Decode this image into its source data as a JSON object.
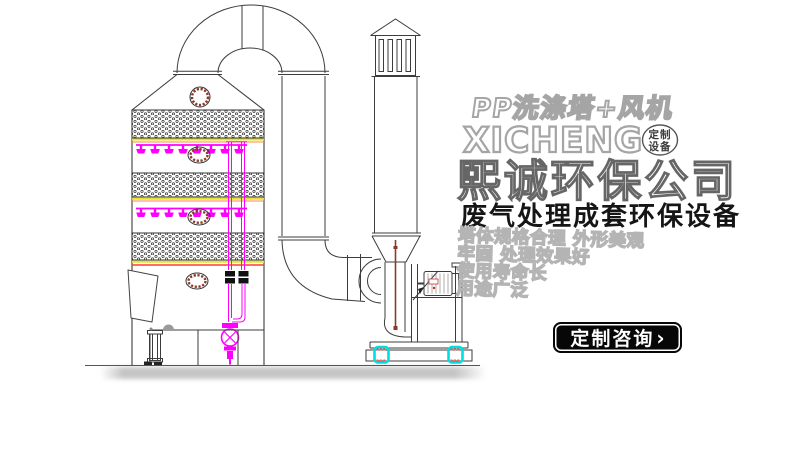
{
  "brand": {
    "product_line": "PP洗涤塔+风机",
    "brand_name": "XICHENG",
    "badge": {
      "line1": "定制",
      "line2": "设备"
    },
    "company_name": "熙诚环保公司",
    "tagline": "废气处理成套环保设备",
    "features": [
      "塔体规格合理 外形美观",
      "牢固 处理效果好",
      "使用寿命长",
      "用途广泛"
    ]
  },
  "cta": {
    "label": "定制咨询",
    "chevron": "›"
  },
  "drawing": {
    "type": "technical-cad-elevation",
    "components": [
      "packed-bed-scrubber-tower",
      "top-cone-with-sight-glass",
      "packing-layers-x3",
      "spray-nozzle-headers-x2",
      "manhole-ports",
      "feed-riser-pipes-with-valves",
      "circulation-pump",
      "water-tank",
      "access-door",
      "exhaust-elbow-duct",
      "centrifugal-fan",
      "fan-motor",
      "vibration-isolators",
      "exhaust-stack-with-rain-cap"
    ],
    "colors": {
      "linework": "#3c3c3c",
      "pipe_magenta": "#ff00ff",
      "support_yellow": "#e3e332",
      "alert_red": "#ff3b30",
      "manhole_ring_darkred": "#8b3a2a",
      "isolator_cyan": "#00dede",
      "shadow_gray": "#bfbfbf",
      "outline_text_gray": "#a5a5a5",
      "cta_background": "#070707"
    }
  }
}
